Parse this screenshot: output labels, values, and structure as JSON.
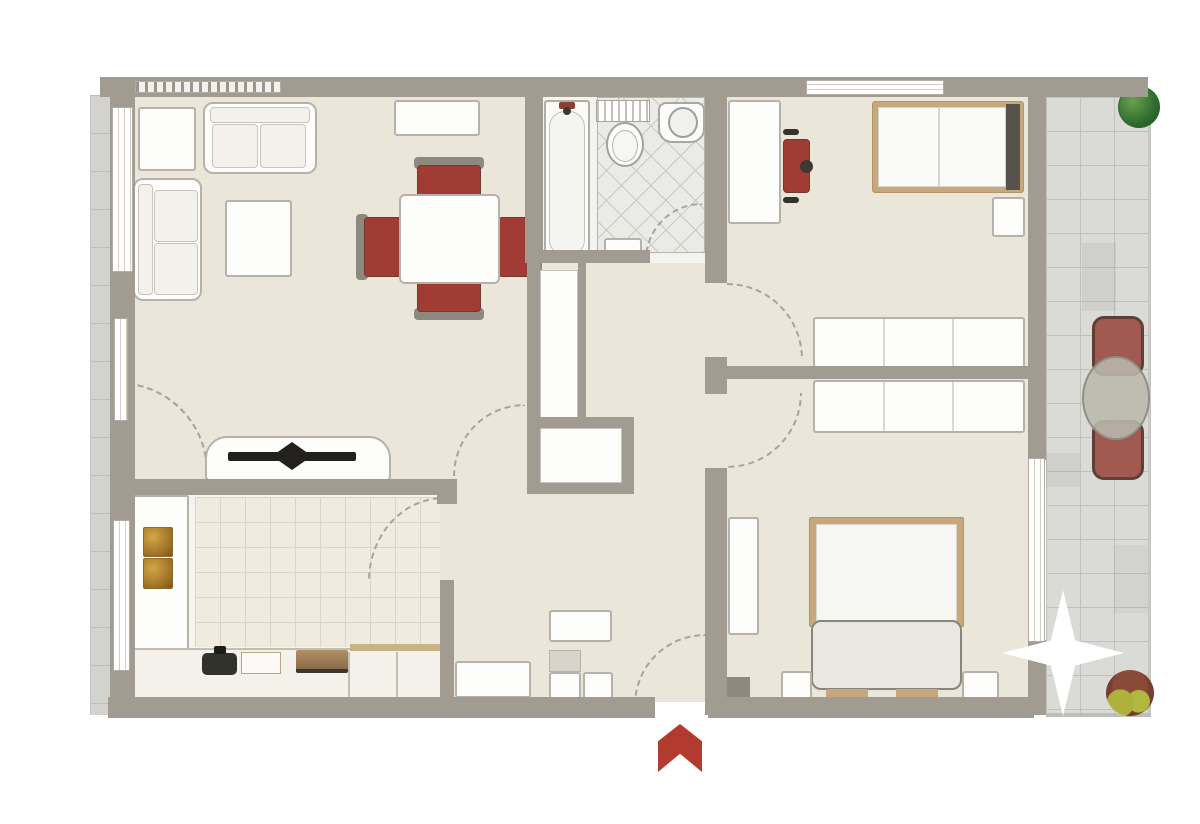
{
  "plan": {
    "kind": "apartment-floor-plan",
    "canvas": {
      "width": 1200,
      "height": 824,
      "background": "#ffffff"
    },
    "rooms": [
      "living-dining-room",
      "kitchen",
      "bathroom",
      "hallway",
      "bedroom-1",
      "bedroom-2",
      "balcony",
      "side-walkway"
    ],
    "palette": {
      "wall": "#a19b92",
      "floor": "#eae6da",
      "balcony_tile": "#dadad6",
      "accent_red": "#a03c34",
      "entrance_arrow_red": "#b23a2e",
      "wood": "#c7a87c",
      "plant_green": "#2e6b2e",
      "furniture_white": "#fdfdfb"
    }
  },
  "elements": [
    {
      "name": "apartment-floor",
      "cls": "floor",
      "x": 112,
      "y": 95,
      "w": 920,
      "h": 607
    },
    {
      "name": "walkway-tiles",
      "cls": "tiles-v",
      "x": 90,
      "y": 95,
      "w": 22,
      "h": 620
    },
    {
      "name": "balcony-tiles",
      "cls": "tiles-grid",
      "x": 1046,
      "y": 97,
      "w": 102,
      "h": 616
    },
    {
      "name": "balcony-right-edge",
      "x": 1148,
      "y": 97,
      "w": 3,
      "h": 616,
      "s": {
        "background": "#c6c6c2"
      }
    },
    {
      "name": "balcony-bottom-edge",
      "x": 1046,
      "y": 713,
      "w": 105,
      "h": 4,
      "s": {
        "background": "#bdbdb9"
      }
    },
    {
      "name": "balcony-tile-shade-1",
      "x": 1082,
      "y": 243,
      "w": 34,
      "h": 68,
      "s": {
        "background": "rgba(90,90,85,0.08)"
      }
    },
    {
      "name": "balcony-tile-shade-2",
      "x": 1046,
      "y": 453,
      "w": 34,
      "h": 34,
      "s": {
        "background": "rgba(90,90,85,0.08)"
      }
    },
    {
      "name": "balcony-tile-shade-3",
      "x": 1114,
      "y": 545,
      "w": 34,
      "h": 68,
      "s": {
        "background": "rgba(90,90,85,0.06)"
      }
    },
    {
      "name": "kitchen-floor",
      "cls": "floor-light",
      "x": 133,
      "y": 493,
      "w": 307,
      "h": 207
    },
    {
      "name": "kitchen-floor-tiles",
      "cls": "tiles-grid-beige",
      "x": 195,
      "y": 497,
      "w": 245,
      "h": 150
    },
    {
      "name": "bathroom-floor",
      "x": 543,
      "y": 97,
      "w": 162,
      "h": 166,
      "s": {
        "background": "#f3f3f0"
      }
    },
    {
      "name": "bathroom-tiles",
      "cls": "lattice",
      "x": 597,
      "y": 97,
      "w": 108,
      "h": 156
    },
    {
      "name": "door-arc-terrace",
      "cls": "arc-tr",
      "x": 118,
      "y": 382,
      "w": 90,
      "h": 90
    },
    {
      "name": "door-arc-living-hall",
      "cls": "arc-tl",
      "x": 453,
      "y": 404,
      "w": 72,
      "h": 72
    },
    {
      "name": "door-arc-kitchen",
      "cls": "arc-tl",
      "x": 368,
      "y": 497,
      "w": 76,
      "h": 84
    },
    {
      "name": "door-arc-bathroom",
      "cls": "arc-tl",
      "x": 645,
      "y": 203,
      "w": 57,
      "h": 57
    },
    {
      "name": "door-arc-bedroom-1",
      "cls": "arc-tr",
      "x": 727,
      "y": 283,
      "w": 76,
      "h": 76
    },
    {
      "name": "door-arc-bedroom-2",
      "cls": "arc-br",
      "x": 727,
      "y": 393,
      "w": 75,
      "h": 75
    },
    {
      "name": "door-arc-entrance",
      "cls": "arc-tl",
      "x": 634,
      "y": 634,
      "w": 71,
      "h": 71
    },
    {
      "name": "living-hutch",
      "cls": "furn",
      "x": 138,
      "y": 107,
      "w": 58,
      "h": 64
    },
    {
      "name": "sofa",
      "cls": "furn furn-round",
      "x": 203,
      "y": 102,
      "w": 114,
      "h": 72
    },
    {
      "name": "sofa-back",
      "cls": "inner",
      "x": 210,
      "y": 107,
      "w": 100,
      "h": 16
    },
    {
      "name": "sofa-cushion",
      "cls": "inner",
      "x": 212,
      "y": 124,
      "w": 46,
      "h": 44
    },
    {
      "name": "sofa-cushion",
      "cls": "inner",
      "x": 260,
      "y": 124,
      "w": 46,
      "h": 44
    },
    {
      "name": "armchair",
      "cls": "furn furn-round",
      "x": 133,
      "y": 178,
      "w": 69,
      "h": 123
    },
    {
      "name": "armchair-back",
      "cls": "inner",
      "x": 138,
      "y": 184,
      "w": 15,
      "h": 111
    },
    {
      "name": "armchair-cushion",
      "cls": "inner",
      "x": 154,
      "y": 190,
      "w": 44,
      "h": 52
    },
    {
      "name": "armchair-cushion",
      "cls": "inner",
      "x": 154,
      "y": 243,
      "w": 44,
      "h": 52
    },
    {
      "name": "coffee-table",
      "cls": "furn",
      "x": 225,
      "y": 200,
      "w": 67,
      "h": 77
    },
    {
      "name": "sideboard",
      "cls": "furn",
      "x": 394,
      "y": 100,
      "w": 86,
      "h": 36
    },
    {
      "name": "dining-chair-halo",
      "cls": "halo",
      "x": 414,
      "y": 157,
      "w": 70,
      "h": 12
    },
    {
      "name": "dining-chair",
      "cls": "red",
      "x": 417,
      "y": 165,
      "w": 64,
      "h": 36
    },
    {
      "name": "dining-chair-halo",
      "cls": "halo",
      "x": 414,
      "y": 308,
      "w": 70,
      "h": 12
    },
    {
      "name": "dining-chair",
      "cls": "red",
      "x": 417,
      "y": 276,
      "w": 64,
      "h": 36
    },
    {
      "name": "dining-chair-halo",
      "cls": "halo",
      "x": 356,
      "y": 214,
      "w": 12,
      "h": 66
    },
    {
      "name": "dining-chair",
      "cls": "red",
      "x": 364,
      "y": 217,
      "w": 38,
      "h": 60
    },
    {
      "name": "dining-chair-halo",
      "cls": "halo",
      "x": 530,
      "y": 214,
      "w": 12,
      "h": 66
    },
    {
      "name": "dining-chair",
      "cls": "red",
      "x": 498,
      "y": 217,
      "w": 38,
      "h": 60
    },
    {
      "name": "dining-table",
      "cls": "furn",
      "x": 399,
      "y": 194,
      "w": 101,
      "h": 90,
      "s": {
        "borderRadius": "6px"
      }
    },
    {
      "name": "tv-console",
      "cls": "furn",
      "x": 205,
      "y": 436,
      "w": 186,
      "h": 46,
      "s": {
        "borderRadius": "22px 22px 6px 6px"
      }
    },
    {
      "name": "tv-screen",
      "cls": "tv-bar",
      "x": 228,
      "y": 452,
      "w": 128,
      "h": 9
    },
    {
      "name": "tv-stand",
      "cls": "tv-stand",
      "x": 272,
      "y": 442,
      "w": 40,
      "h": 28
    },
    {
      "name": "kitchen-counter-left",
      "cls": "furn",
      "x": 133,
      "y": 495,
      "w": 56,
      "h": 182,
      "s": {
        "borderRadius": "2px"
      }
    },
    {
      "name": "cooktop-hob",
      "cls": "hob",
      "x": 143,
      "y": 527,
      "w": 30,
      "h": 30
    },
    {
      "name": "cooktop-hob",
      "cls": "hob",
      "x": 143,
      "y": 558,
      "w": 30,
      "h": 31
    },
    {
      "name": "kitchen-counter-bottom",
      "x": 112,
      "y": 648,
      "w": 331,
      "h": 54,
      "s": {
        "background": "#f3f1e9",
        "border": "2px solid #c2beb5",
        "borderRadius": "2px"
      }
    },
    {
      "name": "counter-divider",
      "x": 348,
      "y": 652,
      "w": 2,
      "h": 48,
      "s": {
        "background": "#c2beb5"
      }
    },
    {
      "name": "counter-divider",
      "x": 396,
      "y": 652,
      "w": 2,
      "h": 48,
      "s": {
        "background": "#c2beb5"
      }
    },
    {
      "name": "counter-edge",
      "x": 350,
      "y": 644,
      "w": 92,
      "h": 7,
      "s": {
        "background": "#c9b286"
      }
    },
    {
      "name": "kitchen-sink",
      "x": 202,
      "y": 653,
      "w": 35,
      "h": 22,
      "s": {
        "background": "#32322c",
        "borderRadius": "5px"
      }
    },
    {
      "name": "sink-faucet",
      "x": 214,
      "y": 646,
      "w": 12,
      "h": 8,
      "s": {
        "background": "#1d1c19",
        "borderRadius": "2px"
      }
    },
    {
      "name": "cutting-board",
      "x": 241,
      "y": 652,
      "w": 40,
      "h": 22,
      "s": {
        "background": "#fbfaf6",
        "border": "1px solid #b8a87e"
      }
    },
    {
      "name": "kitchen-stove",
      "cls": "stove",
      "x": 296,
      "y": 650,
      "w": 52,
      "h": 23
    },
    {
      "name": "entry-cabinet",
      "cls": "furn",
      "x": 455,
      "y": 661,
      "w": 76,
      "h": 37
    },
    {
      "name": "entry-shelf",
      "cls": "furn",
      "x": 549,
      "y": 610,
      "w": 63,
      "h": 32
    },
    {
      "name": "entry-mat",
      "x": 549,
      "y": 650,
      "w": 32,
      "h": 22,
      "s": {
        "background": "#d8d4cc",
        "border": "1px solid #b6b2a9"
      }
    },
    {
      "name": "entry-box",
      "cls": "furn",
      "x": 549,
      "y": 672,
      "w": 32,
      "h": 30
    },
    {
      "name": "entry-box",
      "cls": "furn",
      "x": 583,
      "y": 672,
      "w": 30,
      "h": 30
    },
    {
      "name": "hall-closet-tall",
      "x": 540,
      "y": 270,
      "w": 38,
      "h": 148,
      "s": {
        "background": "#fcfcfa",
        "border": "1px solid #c6c2b9"
      }
    },
    {
      "name": "hall-closet-square",
      "x": 540,
      "y": 428,
      "w": 82,
      "h": 55,
      "s": {
        "background": "#fcfcfa",
        "border": "1px solid #c6c2b9"
      }
    },
    {
      "name": "bathtub",
      "x": 544,
      "y": 100,
      "w": 46,
      "h": 162,
      "s": {
        "background": "#fbfbf9",
        "border": "2px solid #b1ada4",
        "borderRadius": "3px"
      }
    },
    {
      "name": "bathtub-basin",
      "x": 549,
      "y": 111,
      "w": 36,
      "h": 145,
      "s": {
        "background": "#f4f4f1",
        "border": "1px solid #c5c1b8",
        "borderRadius": "16px"
      }
    },
    {
      "name": "tub-faucet",
      "x": 559,
      "y": 102,
      "w": 16,
      "h": 7,
      "s": {
        "background": "#8a4038",
        "borderRadius": "2px"
      }
    },
    {
      "name": "tub-drain",
      "cls": "ellipse",
      "x": 563,
      "y": 107,
      "w": 8,
      "h": 8,
      "s": {
        "background": "#3c3833"
      }
    },
    {
      "name": "towel-radiator",
      "cls": "radiator",
      "x": 596,
      "y": 100,
      "w": 54,
      "h": 22
    },
    {
      "name": "toilet-bowl",
      "cls": "ellipse",
      "x": 606,
      "y": 122,
      "w": 38,
      "h": 45,
      "s": {
        "background": "#fcfcfa",
        "border": "2px solid #a5a19a"
      }
    },
    {
      "name": "toilet-seat",
      "cls": "ellipse",
      "x": 612,
      "y": 130,
      "w": 26,
      "h": 32,
      "s": {
        "background": "#f6f6f3",
        "border": "1px solid #b8b4ad"
      }
    },
    {
      "name": "bathroom-sink",
      "x": 658,
      "y": 102,
      "w": 47,
      "h": 41,
      "s": {
        "background": "#fbfbf9",
        "border": "2px solid #aaa6a0",
        "borderRadius": "8px 8px 14px 14px"
      }
    },
    {
      "name": "sink-basin",
      "cls": "ellipse",
      "x": 668,
      "y": 107,
      "w": 30,
      "h": 31,
      "s": {
        "background": "#f0f1ee",
        "border": "2px solid #9aa09a"
      }
    },
    {
      "name": "bath-shelf",
      "cls": "furn",
      "x": 604,
      "y": 238,
      "w": 38,
      "h": 22
    },
    {
      "name": "desk",
      "cls": "furn",
      "x": 728,
      "y": 100,
      "w": 53,
      "h": 124
    },
    {
      "name": "desk-chair",
      "cls": "red",
      "x": 783,
      "y": 139,
      "w": 27,
      "h": 54
    },
    {
      "name": "desk-chair-knob",
      "cls": "ellipse",
      "x": 800,
      "y": 160,
      "w": 13,
      "h": 13,
      "s": {
        "background": "#3c3833"
      }
    },
    {
      "name": "desk-chair-arm",
      "x": 783,
      "y": 129,
      "w": 16,
      "h": 6,
      "s": {
        "background": "#35312b",
        "borderRadius": "3px"
      }
    },
    {
      "name": "desk-chair-arm",
      "x": 783,
      "y": 197,
      "w": 16,
      "h": 6,
      "s": {
        "background": "#35312b",
        "borderRadius": "3px"
      }
    },
    {
      "name": "single-bed-frame",
      "x": 872,
      "y": 101,
      "w": 152,
      "h": 92,
      "s": {
        "background": "#c7a87c",
        "border": "1px solid #b29467",
        "borderRadius": "3px"
      }
    },
    {
      "name": "single-bed-mattress",
      "x": 878,
      "y": 107,
      "w": 128,
      "h": 80,
      "s": {
        "background": "#fafaf7",
        "border": "1px solid #d8d5cd"
      }
    },
    {
      "name": "single-bed-fold",
      "x": 938,
      "y": 108,
      "w": 2,
      "h": 78,
      "s": {
        "background": "#d8d5cd"
      }
    },
    {
      "name": "single-bed-headboard",
      "x": 1006,
      "y": 104,
      "w": 14,
      "h": 86,
      "s": {
        "background": "#57524b"
      }
    },
    {
      "name": "nightstand",
      "cls": "furn",
      "x": 992,
      "y": 197,
      "w": 33,
      "h": 40
    },
    {
      "name": "wardrobe",
      "cls": "furn divided-3",
      "x": 813,
      "y": 317,
      "w": 212,
      "h": 51
    },
    {
      "name": "wardrobe",
      "cls": "furn divided-3",
      "x": 813,
      "y": 380,
      "w": 212,
      "h": 53
    },
    {
      "name": "bedroom-shelf",
      "cls": "furn",
      "x": 728,
      "y": 517,
      "w": 31,
      "h": 118
    },
    {
      "name": "wall-pier",
      "x": 727,
      "y": 677,
      "w": 23,
      "h": 28,
      "s": {
        "background": "#8e897f"
      }
    },
    {
      "name": "double-bed-frame",
      "x": 809,
      "y": 517,
      "w": 155,
      "h": 110,
      "s": {
        "background": "#c7a87c",
        "border": "1px solid #b29467",
        "borderRadius": "2px"
      }
    },
    {
      "name": "double-bed-duvet",
      "x": 816,
      "y": 524,
      "w": 141,
      "h": 97,
      "s": {
        "background": "#f6f6f2",
        "border": "1px solid #d8d5cd"
      }
    },
    {
      "name": "double-bed-footpad",
      "x": 811,
      "y": 620,
      "w": 151,
      "h": 70,
      "s": {
        "background": "#e8e7e2",
        "border": "2px solid #8a857c",
        "borderRadius": "10px"
      }
    },
    {
      "name": "bed-foot",
      "x": 826,
      "y": 689,
      "w": 42,
      "h": 16,
      "s": {
        "background": "#c7a87c"
      }
    },
    {
      "name": "bed-foot",
      "x": 896,
      "y": 689,
      "w": 42,
      "h": 16,
      "s": {
        "background": "#c7a87c"
      }
    },
    {
      "name": "nightstand",
      "cls": "furn",
      "x": 781,
      "y": 671,
      "w": 31,
      "h": 31
    },
    {
      "name": "nightstand",
      "cls": "furn",
      "x": 962,
      "y": 671,
      "w": 37,
      "h": 31
    },
    {
      "name": "balcony-plant",
      "cls": "plant-green",
      "x": 1118,
      "y": 86,
      "w": 42,
      "h": 42
    },
    {
      "name": "patio-chair",
      "cls": "patio-chair",
      "x": 1092,
      "y": 316,
      "w": 52,
      "h": 60
    },
    {
      "name": "patio-chair",
      "cls": "patio-chair",
      "x": 1092,
      "y": 420,
      "w": 52,
      "h": 60
    },
    {
      "name": "patio-table",
      "cls": "patio-table",
      "x": 1082,
      "y": 356,
      "w": 68,
      "h": 84
    },
    {
      "name": "balcony-plant-autumn",
      "cls": "plant-autumn",
      "x": 1106,
      "y": 670,
      "w": 48,
      "h": 46
    },
    {
      "name": "wall-top",
      "cls": "wall",
      "x": 100,
      "y": 77,
      "w": 1048,
      "h": 20
    },
    {
      "name": "wall-left",
      "cls": "wall",
      "x": 110,
      "y": 95,
      "w": 25,
      "h": 620
    },
    {
      "name": "wall-bottom-left",
      "cls": "wall",
      "x": 108,
      "y": 697,
      "w": 547,
      "h": 21
    },
    {
      "name": "wall-bottom-right",
      "cls": "wall",
      "x": 708,
      "y": 697,
      "w": 326,
      "h": 21
    },
    {
      "name": "wall-right-upper",
      "cls": "wall",
      "x": 1028,
      "y": 95,
      "w": 18,
      "h": 365
    },
    {
      "name": "wall-right-lower",
      "cls": "wall",
      "x": 1028,
      "y": 640,
      "w": 18,
      "h": 75
    },
    {
      "name": "wall-bathroom-left",
      "cls": "wall",
      "x": 525,
      "y": 95,
      "w": 18,
      "h": 168
    },
    {
      "name": "wall-bathroom-bottom",
      "cls": "wall",
      "x": 525,
      "y": 250,
      "w": 125,
      "h": 13
    },
    {
      "name": "wall-hall-upper",
      "cls": "wall",
      "x": 705,
      "y": 95,
      "w": 22,
      "h": 188
    },
    {
      "name": "wall-junction",
      "cls": "wall",
      "x": 705,
      "y": 357,
      "w": 22,
      "h": 37
    },
    {
      "name": "wall-bedroom-divider",
      "cls": "wall",
      "x": 727,
      "y": 366,
      "w": 301,
      "h": 13
    },
    {
      "name": "wall-hall-lower",
      "cls": "wall",
      "x": 705,
      "y": 468,
      "w": 22,
      "h": 247
    },
    {
      "name": "wall-closet-left",
      "cls": "wall",
      "x": 527,
      "y": 263,
      "w": 13,
      "h": 229
    },
    {
      "name": "wall-niche-right",
      "cls": "wall",
      "x": 578,
      "y": 263,
      "w": 8,
      "h": 157
    },
    {
      "name": "wall-closet-top",
      "cls": "wall",
      "x": 527,
      "y": 417,
      "w": 107,
      "h": 11
    },
    {
      "name": "wall-closet-right",
      "cls": "wall",
      "x": 622,
      "y": 417,
      "w": 12,
      "h": 77
    },
    {
      "name": "wall-closet-bottom",
      "cls": "wall",
      "x": 527,
      "y": 483,
      "w": 107,
      "h": 11
    },
    {
      "name": "wall-kitchen-top",
      "cls": "wall",
      "x": 112,
      "y": 479,
      "w": 345,
      "h": 16
    },
    {
      "name": "wall-kitchen-cap",
      "cls": "wall",
      "x": 437,
      "y": 479,
      "w": 20,
      "h": 25
    },
    {
      "name": "wall-kitchen-right",
      "cls": "wall",
      "x": 440,
      "y": 580,
      "w": 14,
      "h": 122
    },
    {
      "name": "window-band-hatched",
      "cls": "hatch",
      "x": 135,
      "y": 81,
      "w": 146,
      "h": 12
    },
    {
      "name": "window-living",
      "cls": "window-v",
      "x": 112,
      "y": 107,
      "w": 21,
      "h": 165
    },
    {
      "name": "window-living-narrow",
      "cls": "window-v",
      "x": 114,
      "y": 318,
      "w": 14,
      "h": 103
    },
    {
      "name": "window-kitchen",
      "cls": "window-v",
      "x": 113,
      "y": 520,
      "w": 17,
      "h": 151
    },
    {
      "name": "window-bedroom-1",
      "cls": "window-h",
      "x": 806,
      "y": 80,
      "w": 138,
      "h": 15
    },
    {
      "name": "balcony-door",
      "cls": "window-v",
      "x": 1028,
      "y": 458,
      "w": 17,
      "h": 184
    },
    {
      "name": "glare-star",
      "cls": "star",
      "x": 1002,
      "y": 590,
      "w": 122,
      "h": 126,
      "s": {
        "zIndex": "9"
      }
    },
    {
      "name": "entrance-arrow",
      "cls": "chevron",
      "x": 658,
      "y": 724,
      "w": 44,
      "h": 48,
      "s": {
        "zIndex": "9"
      }
    }
  ]
}
